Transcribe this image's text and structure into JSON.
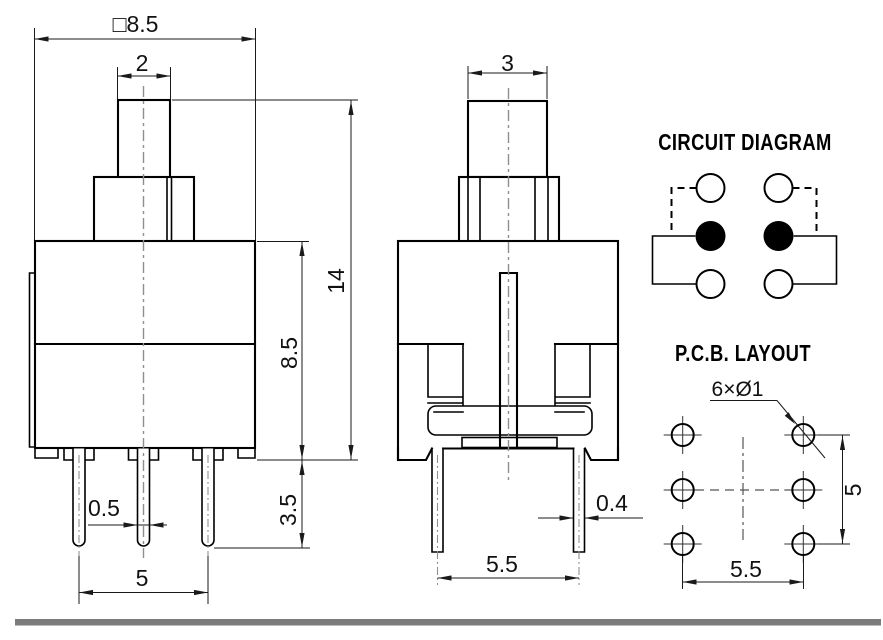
{
  "front_view": {
    "dims": {
      "body_width": "□8.5",
      "plunger_width": "2",
      "total_height": "14",
      "body_height": "8.5",
      "pin_exposed_length": "3.5",
      "pin_width": "0.5",
      "pin_spacing": "5"
    }
  },
  "side_view": {
    "dims": {
      "plunger_width": "3",
      "pin_thickness": "0.4",
      "pin_spacing": "5.5"
    }
  },
  "circuit_diagram": {
    "title": "CIRCUIT DIAGRAM"
  },
  "pcb_layout": {
    "title": "P.C.B. LAYOUT",
    "hole_callout": "6×Ø1",
    "vertical_pitch": "5",
    "horizontal_pitch": "5.5"
  },
  "colors": {
    "line": "#000000",
    "dimension": "#1a1a1a",
    "centerline": "#8f8f8f",
    "separator": "#7b7b7b",
    "background": "#ffffff"
  }
}
